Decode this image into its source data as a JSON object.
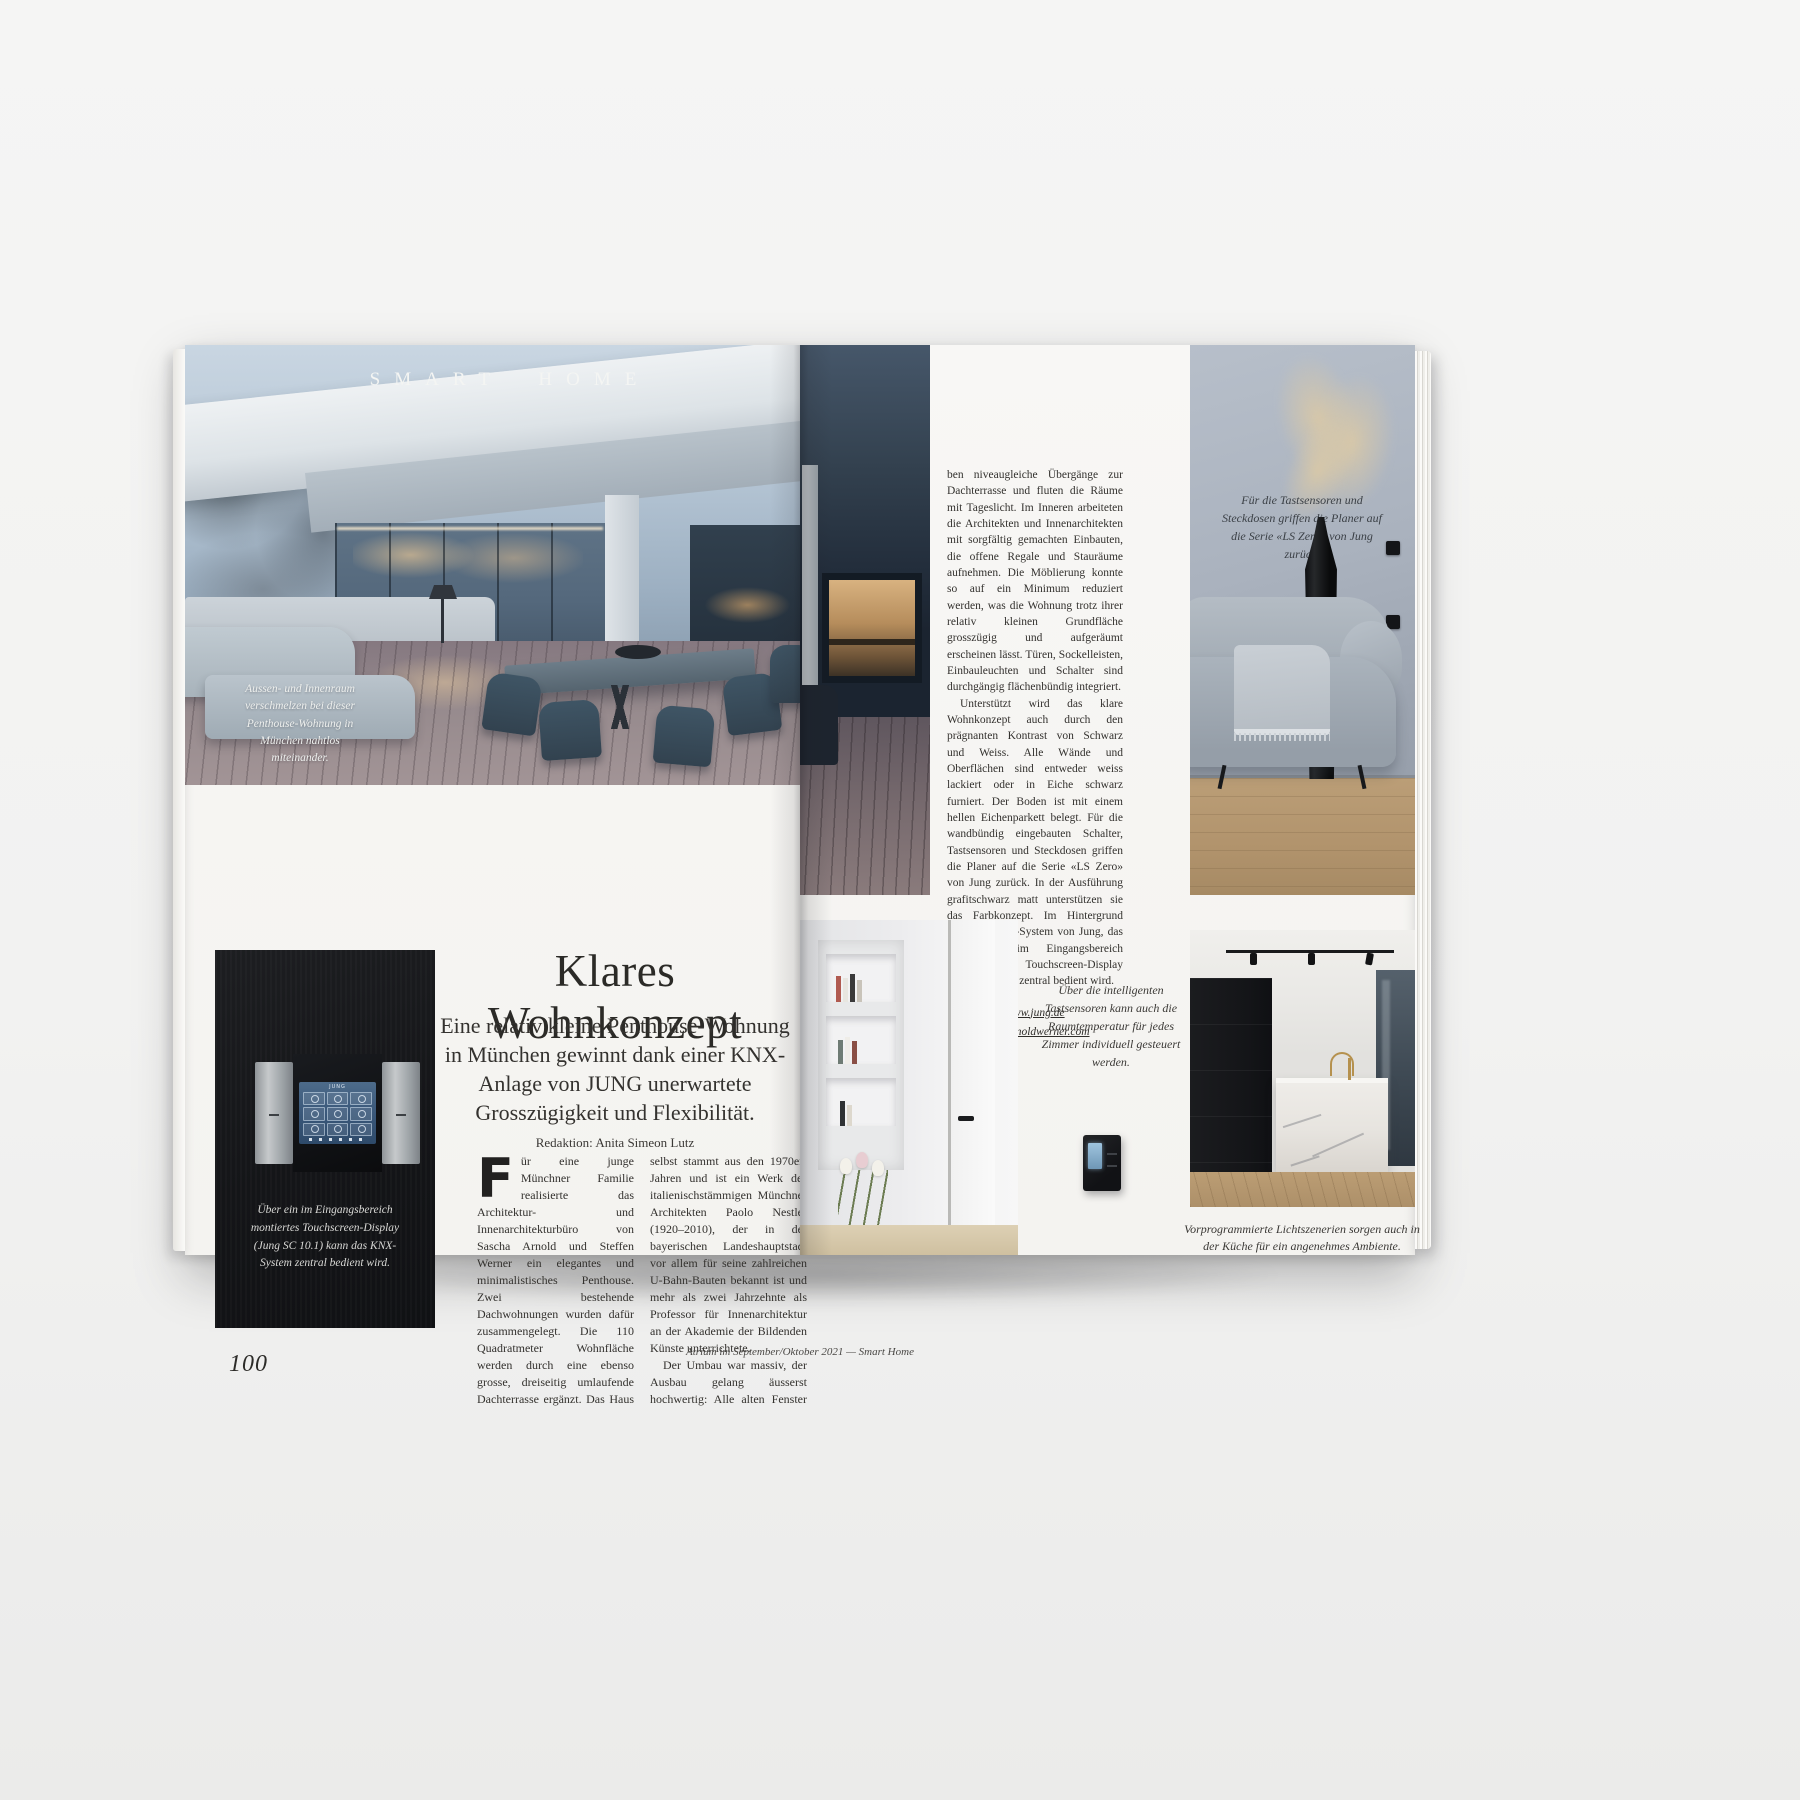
{
  "colors": {
    "background": "#f2f2f1",
    "paper": "#f7f6f3",
    "ink": "#2e2c29",
    "panel_black": "#141518",
    "screen_blue": "#3a587a",
    "wood_floor": "#b1936c",
    "wall_gray_blue": "#a8b0bc"
  },
  "spread": {
    "left_page": {
      "section_label": "SMART HOME",
      "hero_caption": "Aussen- und Innenraum verschmelzen bei dieser Penthouse-Wohnung in München nahtlos miteinander.",
      "headline": "Klares Wohnkonzept",
      "subtitle": "Eine relativ kleine Penthouse-Wohnung in München gewinnt dank einer KNX-Anlage von JUNG unerwartete Grosszügigkeit und Flexibilität.",
      "byline": "Redaktion: Anita Simeon Lutz",
      "dropcap": "F",
      "body_p1": "ür eine junge Münchner Familie realisierte das Architektur- und Innenarchitekturbüro von Sascha Arnold und Steffen Werner ein elegantes und minimalistisches Penthouse. Zwei bestehende Dachwohnungen wurden dafür zusammengelegt. Die 110 Quadratmeter Wohnfläche werden durch eine ebenso grosse, dreiseitig umlaufende Dachterrasse ergänzt. Das Haus selbst stammt aus den 1970er-Jahren und ist ein Werk des italienischstämmigen Münchner Architekten Paolo Nestler (1920–2010), der in der bayerischen Landeshauptstadt vor allem für seine zahlreichen U-Bahn-Bauten bekannt ist und mehr als zwei Jahrzehnte als Professor für Innenarchitektur an der Akademie der Bildenden Künste unterrichtete.",
      "body_p2": "Der Umbau war massiv, der Ausbau gelang äusserst hochwertig: Alle alten Fenster wurden ausgetauscht und neue, filigrane Schiebefensterelemente installiert. Sie erlan-",
      "touchscreen_brand": "JUNG",
      "display_caption": "Über ein im Eingangsbereich montiertes Touchscreen-Display (Jung SC 10.1) kann das KNX-System zentral bedient wird.",
      "page_number": "100",
      "footer_credit": "Atrium im September/Oktober 2021 — Smart Home"
    },
    "right_page": {
      "col_par1": "ben niveaugleiche Übergänge zur Dachterrasse und fluten die Räume mit Tageslicht. Im Inneren arbeiteten die Architekten und Innenarchitekten mit sorgfältig gemachten Einbauten, die offene Regale und Stauräume aufnehmen. Die Möblierung konnte so auf ein Minimum reduziert werden, was die Wohnung trotz ihrer relativ kleinen Grundfläche grosszügig und aufgeräumt erscheinen lässt. Türen, Sockelleisten, Einbauleuchten und Schalter sind durchgängig flächenbündig integriert.",
      "col_par2": "Unterstützt wird das klare Wohnkonzept auch durch den prägnanten Kontrast von Schwarz und Weiss. Alle Wände und Oberflächen sind entweder weiss lackiert oder in Eiche schwarz furniert. Der Boden ist mit einem hellen Eichenparkett belegt. Für die wandbündig eingebauten Schalter, Tastsensoren und Steckdosen griffen die Planer auf die Serie «LS Zero» von Jung zurück. In der Ausführung grafitschwarz matt unterstützen sie das Farbkonzept. Im Hintergrund läuft ein KNX-System von Jung, das über ein im Eingangsbereich montiertes Touchscreen-Display (Jung SC 10.1) zentral bedient wird.",
      "link_jung": "www.jung.de",
      "link_arnoldwerner": "www.arnoldwerner.com",
      "sofa_caption": "Für die Tastsensoren und Steckdosen griffen die Planer auf die Serie «LS Zero» von Jung zurück.",
      "switch_caption": "Über die intelligenten Tastsensoren kann auch die Raumtemperatur für jedes Zimmer individuell gesteuert werden.",
      "kitchen_caption": "Vorprogrammierte Lichtszenerien sorgen auch in der Küche für ein angenehmes Ambiente."
    }
  }
}
